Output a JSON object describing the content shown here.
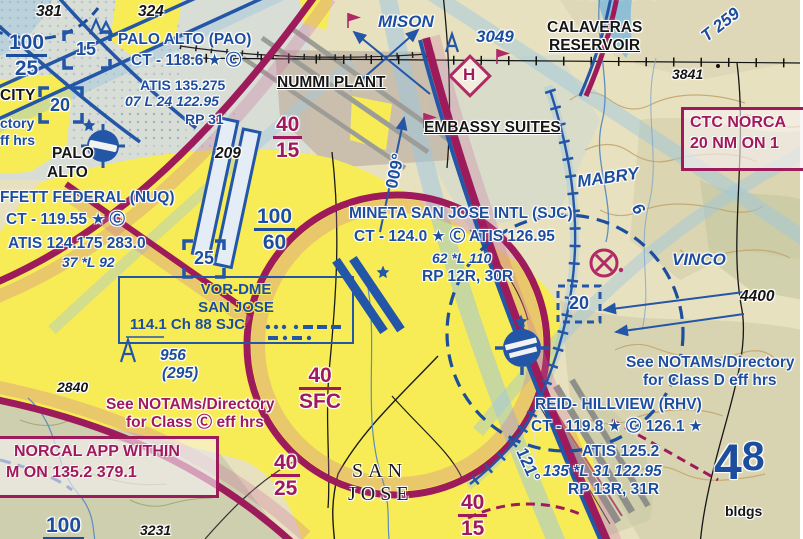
{
  "boxes": {
    "vor": {
      "line1": "VOR-DME",
      "line2": "SAN JOSE",
      "line3": "114.1 Ch 88 SJC"
    },
    "norcal": {
      "line1": "NORCAL APP WITHIN",
      "line2": "M ON 135.2 379.1"
    },
    "ctc": {
      "line1": "CTC NORCA",
      "line2": "20 NM ON 1"
    }
  },
  "map": {
    "labels": [
      {
        "name": "spot-elev-381",
        "text": "381",
        "x": 36,
        "y": 4,
        "cls": "blk it lg"
      },
      {
        "name": "spot-elev-324",
        "text": "324",
        "x": 138,
        "y": 4,
        "cls": "blk it lg"
      },
      {
        "name": "apt-pao-name",
        "text": "PALO ALTO (PAO)",
        "x": 118,
        "y": 32,
        "cls": "blue lg"
      },
      {
        "name": "apt-pao-ct",
        "text": "CT - 118.6 ★ Ⓒ",
        "x": 131,
        "y": 53,
        "cls": "blue lg"
      },
      {
        "name": "apt-pao-atis",
        "text": "ATIS 135.275",
        "x": 140,
        "y": 78,
        "cls": "blue"
      },
      {
        "name": "apt-pao-rwy",
        "text": "07 L 24 122.95",
        "x": 125,
        "y": 94,
        "cls": "blue it"
      },
      {
        "name": "apt-pao-rp",
        "text": "RP 31",
        "x": 185,
        "y": 112,
        "cls": "blue"
      },
      {
        "name": "classb-alt-100-25",
        "text": "100/25",
        "x": 6,
        "y": 32,
        "cls": "blue frac",
        "type": "frac"
      },
      {
        "name": "alt-box-15",
        "text": "15",
        "x": 76,
        "y": 40,
        "cls": "blue bracket-num"
      },
      {
        "name": "alt-box-20-left",
        "text": "20",
        "x": 50,
        "y": 96,
        "cls": "blue bracket-num"
      },
      {
        "name": "city-fragment",
        "text": "CITY",
        "x": 0,
        "y": 88,
        "cls": "blk lg"
      },
      {
        "name": "notam-fragment-1",
        "text": "ctory",
        "x": 0,
        "y": 116,
        "cls": "blue"
      },
      {
        "name": "notam-fragment-2",
        "text": "ff hrs",
        "x": 0,
        "y": 133,
        "cls": "blue"
      },
      {
        "name": "city-palo",
        "text": "PALO",
        "x": 52,
        "y": 146,
        "cls": "blk lg"
      },
      {
        "name": "city-alto",
        "text": "ALTO",
        "x": 47,
        "y": 165,
        "cls": "blk lg"
      },
      {
        "name": "apt-nuq-name",
        "text": "FFETT FEDERAL (NUQ)",
        "x": 0,
        "y": 190,
        "cls": "blue lg"
      },
      {
        "name": "apt-nuq-ct",
        "text": "CT - 119.55 ★ Ⓒ",
        "x": 6,
        "y": 212,
        "cls": "blue lg"
      },
      {
        "name": "apt-nuq-atis",
        "text": "ATIS 124.175  283.0",
        "x": 8,
        "y": 236,
        "cls": "blue lg"
      },
      {
        "name": "apt-nuq-rwy",
        "text": "37 *L 92",
        "x": 62,
        "y": 255,
        "cls": "blue it"
      },
      {
        "name": "spot-elev-209",
        "text": "209",
        "x": 215,
        "y": 146,
        "cls": "blk it lg"
      },
      {
        "name": "classb-alt-100-60",
        "text": "100/60",
        "x": 254,
        "y": 206,
        "cls": "blue frac",
        "type": "frac"
      },
      {
        "name": "alt-box-25",
        "text": "25",
        "x": 194,
        "y": 249,
        "cls": "blue bracket-num"
      },
      {
        "name": "obstacle-956",
        "text": "956",
        "x": 160,
        "y": 348,
        "cls": "blue it lg"
      },
      {
        "name": "obstacle-956-agl",
        "text": "(295)",
        "x": 162,
        "y": 366,
        "cls": "blue it lg"
      },
      {
        "name": "spot-elev-2840",
        "text": "2840",
        "x": 57,
        "y": 380,
        "cls": "blk it"
      },
      {
        "name": "notam-classc-1",
        "text": "See NOTAMs/Directory",
        "x": 106,
        "y": 397,
        "cls": "mag lg"
      },
      {
        "name": "notam-classc-2",
        "text": "for Class Ⓒ eff hrs",
        "x": 126,
        "y": 415,
        "cls": "mag lg"
      },
      {
        "name": "classb-alt-100-partial",
        "text": "100/",
        "x": 43,
        "y": 515,
        "cls": "blue frac",
        "type": "frac"
      },
      {
        "name": "spot-elev-3231",
        "text": "3231",
        "x": 140,
        "y": 523,
        "cls": "blk it"
      },
      {
        "name": "classc-alt-40-15-west",
        "text": "40/15",
        "x": 273,
        "y": 114,
        "cls": "mag frac",
        "type": "frac"
      },
      {
        "name": "classc-alt-40-sfc",
        "text": "40/SFC",
        "x": 299,
        "y": 365,
        "cls": "mag frac",
        "type": "frac"
      },
      {
        "name": "classc-alt-40-25",
        "text": "40/25",
        "x": 271,
        "y": 452,
        "cls": "mag frac",
        "type": "frac"
      },
      {
        "name": "classc-alt-40-15-south",
        "text": "40/15",
        "x": 458,
        "y": 492,
        "cls": "mag frac",
        "type": "frac"
      },
      {
        "name": "city-san",
        "text": "SAN",
        "x": 352,
        "y": 461,
        "cls": "serif"
      },
      {
        "name": "city-jose",
        "text": "JOSE",
        "x": 348,
        "y": 484,
        "cls": "serif"
      },
      {
        "name": "landmark-nummi-plant",
        "text": "NUMMI PLANT",
        "x": 277,
        "y": 75,
        "cls": "blk lg ul"
      },
      {
        "name": "landmark-embassy-suites",
        "text": "EMBASSY SUITES",
        "x": 424,
        "y": 120,
        "cls": "blk lg ul"
      },
      {
        "name": "waypoint-mison",
        "text": "MISON",
        "x": 378,
        "y": 13,
        "cls": "blue it xl"
      },
      {
        "name": "obstacle-3049",
        "text": "3049",
        "x": 476,
        "y": 28,
        "cls": "blue it xl"
      },
      {
        "name": "reservoir-calaveras-1",
        "text": "CALAVERAS",
        "x": 547,
        "y": 20,
        "cls": "blk lg"
      },
      {
        "name": "reservoir-calaveras-2",
        "text": "RESERVOIR",
        "x": 549,
        "y": 38,
        "cls": "blk lg ul"
      },
      {
        "name": "airway-t259",
        "text": "T 259",
        "x": 699,
        "y": 16,
        "cls": "blue it xl",
        "rot": -38
      },
      {
        "name": "spot-elev-3841",
        "text": "3841",
        "x": 672,
        "y": 67,
        "cls": "blk it"
      },
      {
        "name": "classc-ring-label",
        "text": "CLASS C",
        "x": 574,
        "y": -13,
        "cls": "mag lg sp"
      },
      {
        "name": "bearing-009",
        "text": "009°",
        "x": 378,
        "y": 162,
        "cls": "blue xl",
        "rot": -78
      },
      {
        "name": "apt-sjc-name",
        "text": "MINETA SAN JOSE INTL (SJC)",
        "x": 349,
        "y": 206,
        "cls": "blue lg"
      },
      {
        "name": "apt-sjc-ct",
        "text": "CT - 124.0 ★ Ⓒ ATIS 126.95",
        "x": 354,
        "y": 229,
        "cls": "blue lg"
      },
      {
        "name": "apt-sjc-rwy",
        "text": "62 *L 110",
        "x": 432,
        "y": 251,
        "cls": "blue it"
      },
      {
        "name": "apt-sjc-rp",
        "text": "RP 12R, 30R",
        "x": 422,
        "y": 269,
        "cls": "blue lg"
      },
      {
        "name": "waypoint-mabry",
        "text": "MABRY",
        "x": 577,
        "y": 169,
        "cls": "blue it xl",
        "rot": -8
      },
      {
        "name": "airway-6",
        "text": "6",
        "x": 633,
        "y": 200,
        "cls": "blue it xl",
        "rot": 58
      },
      {
        "name": "waypoint-vinco",
        "text": "VINCO",
        "x": 672,
        "y": 251,
        "cls": "blue it xl"
      },
      {
        "name": "spot-elev-4400",
        "text": "4400",
        "x": 740,
        "y": 289,
        "cls": "blk it lg"
      },
      {
        "name": "alt-box-20-right",
        "text": "20",
        "x": 569,
        "y": 294,
        "cls": "blue bracket-num"
      },
      {
        "name": "notam-classd-1",
        "text": "See NOTAMs/Directory",
        "x": 626,
        "y": 355,
        "cls": "blue lg"
      },
      {
        "name": "notam-classd-2",
        "text": "for Class D eff hrs",
        "x": 643,
        "y": 373,
        "cls": "blue lg"
      },
      {
        "name": "apt-rhv-name",
        "text": "REID- HILLVIEW (RHV)",
        "x": 535,
        "y": 397,
        "cls": "blue lg"
      },
      {
        "name": "apt-rhv-ct",
        "text": "CT - 119.8 ★ Ⓒ 126.1 ★",
        "x": 531,
        "y": 419,
        "cls": "blue lg"
      },
      {
        "name": "apt-rhv-atis",
        "text": "ATIS 125.2",
        "x": 582,
        "y": 444,
        "cls": "blue lg"
      },
      {
        "name": "apt-rhv-rwy",
        "text": "135 *L 31  122.95",
        "x": 543,
        "y": 464,
        "cls": "blue it lg"
      },
      {
        "name": "apt-rhv-rp",
        "text": "RP 13R, 31R",
        "x": 568,
        "y": 482,
        "cls": "blue lg"
      },
      {
        "name": "mef-48",
        "text": "48",
        "x": 714,
        "y": 434,
        "cls": "blue mef",
        "type": "mef"
      },
      {
        "name": "bearing-121",
        "text": "121°",
        "x": 510,
        "y": 456,
        "cls": "blue xl",
        "rot": 66
      },
      {
        "name": "helipad-h",
        "text": "H",
        "x": 463,
        "y": 66,
        "cls": "mag xl"
      },
      {
        "name": "landmark-bldgs",
        "text": "bldgs",
        "x": 725,
        "y": 504,
        "cls": "blk"
      }
    ]
  }
}
